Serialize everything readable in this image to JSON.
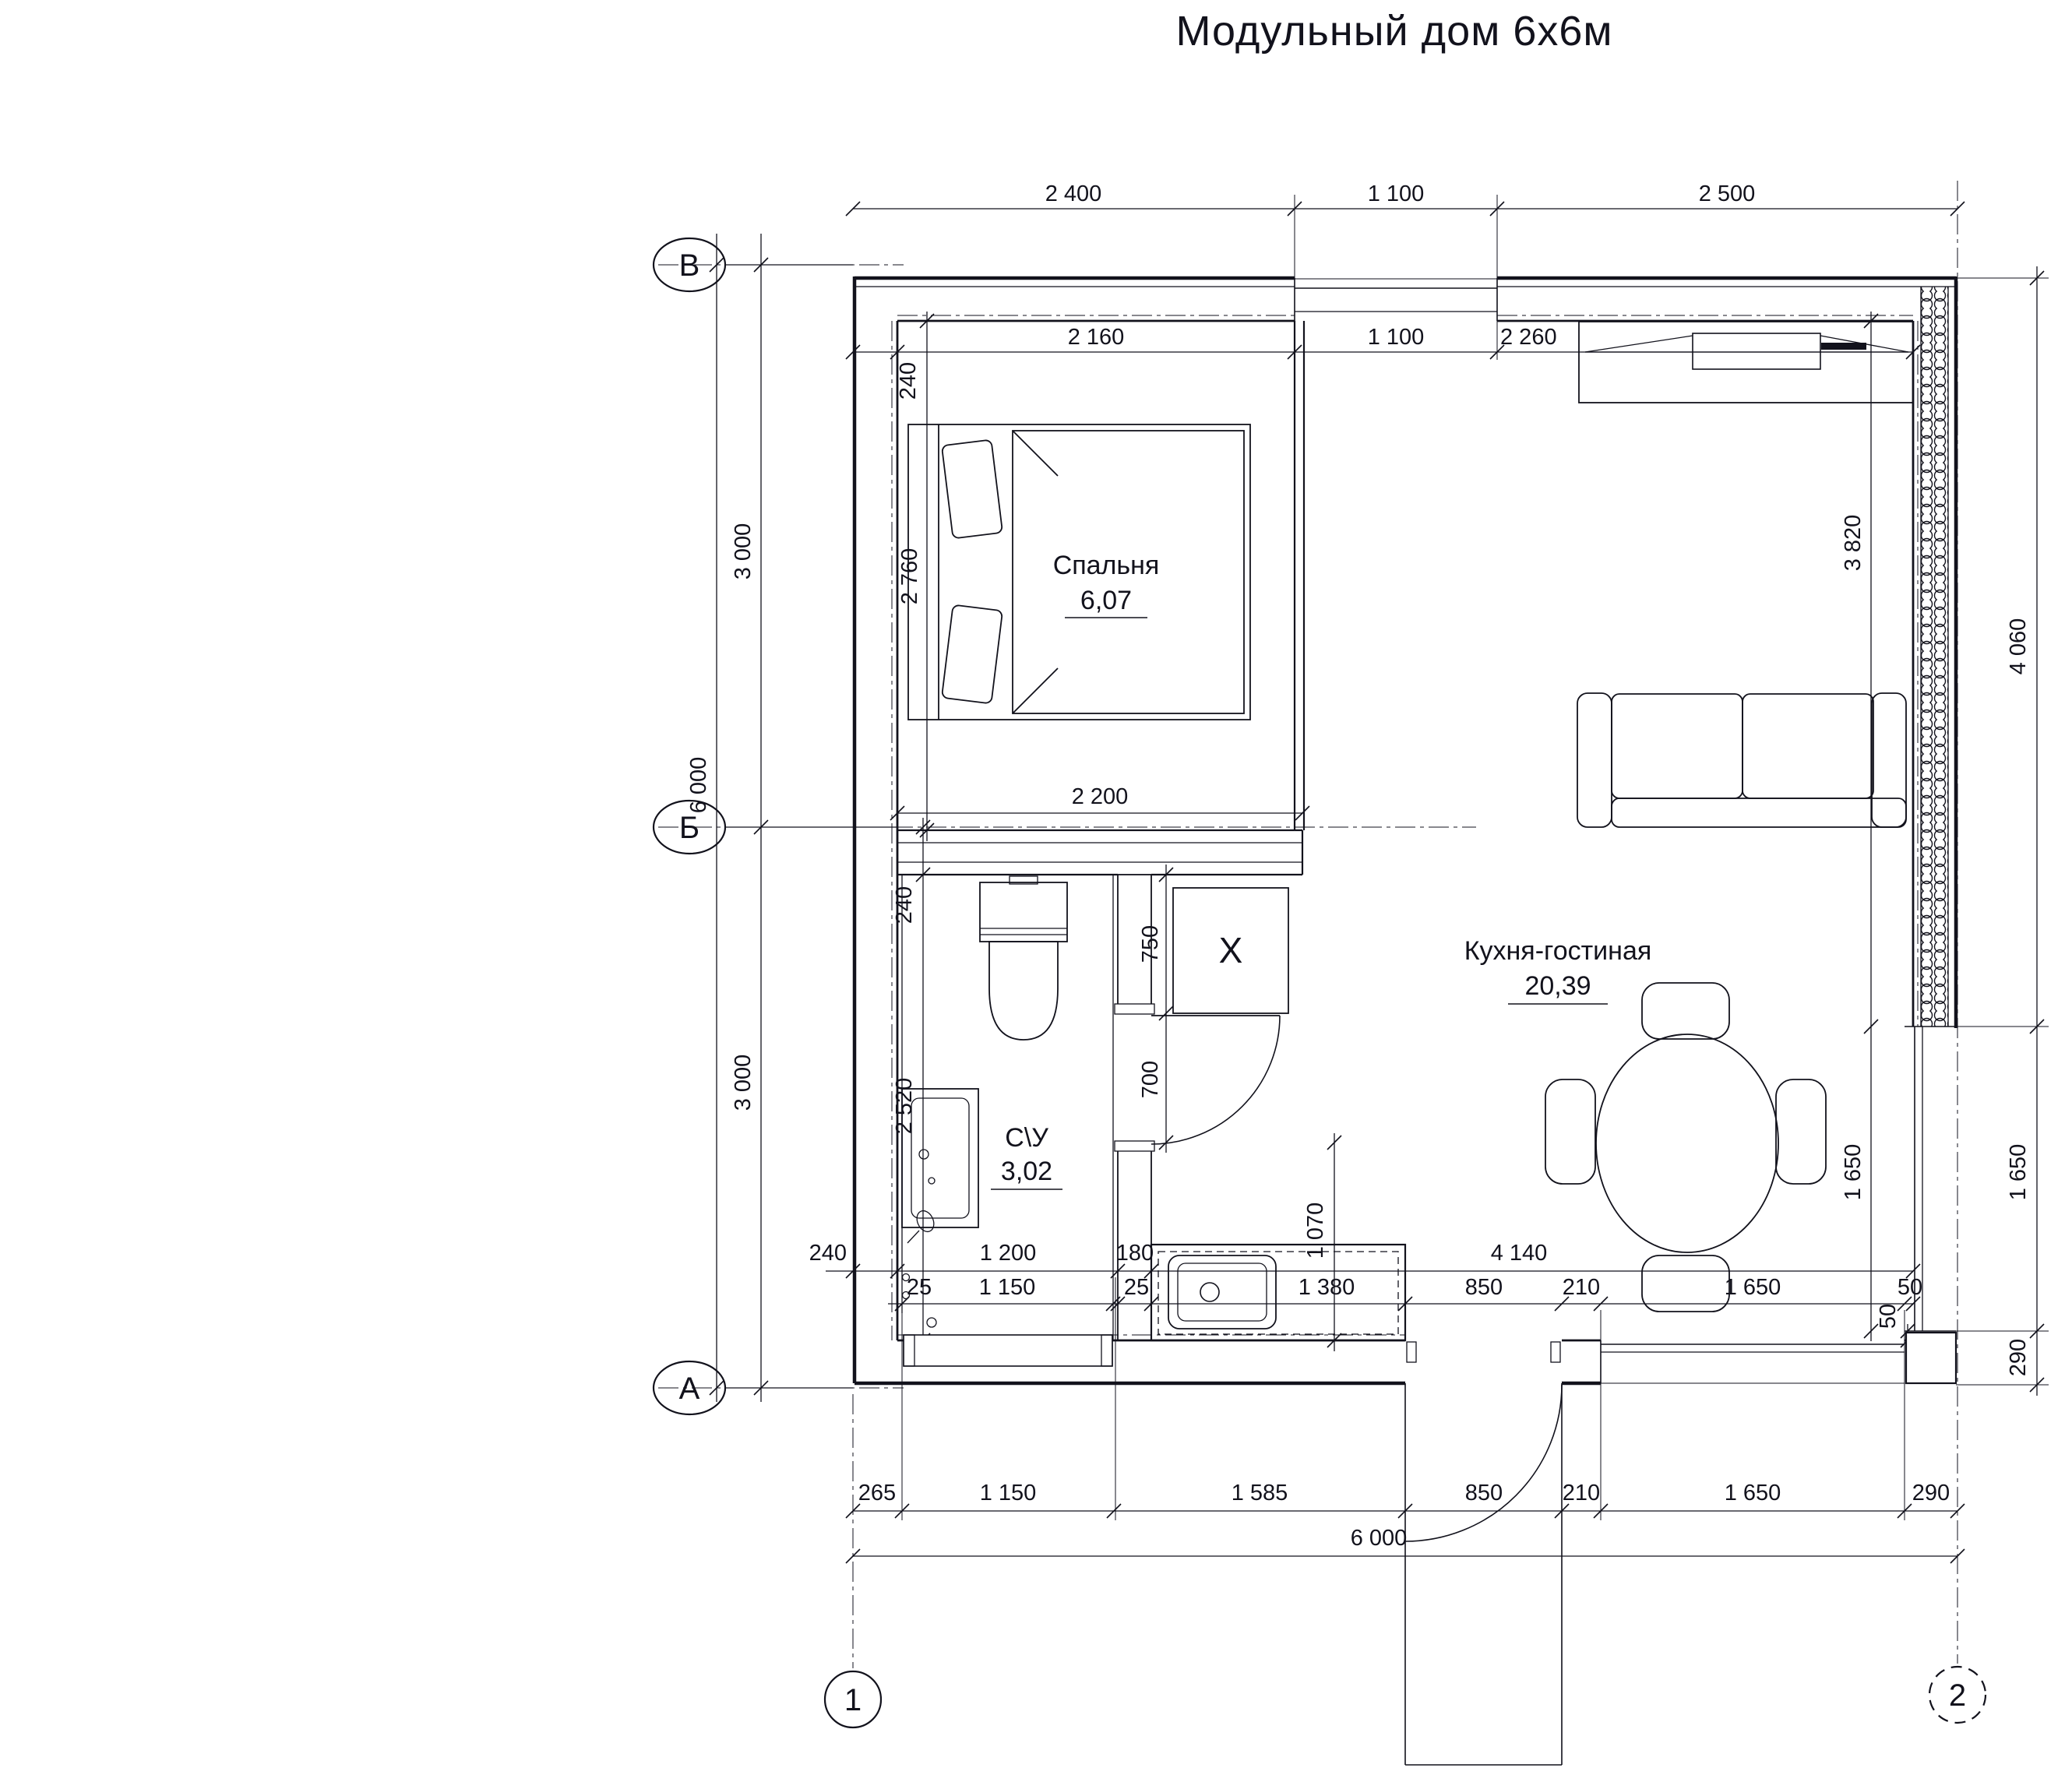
{
  "title": "Модульный дом 6х6м",
  "axes": {
    "rows": [
      "В",
      "Б",
      "А"
    ],
    "cols": [
      "1",
      "2"
    ]
  },
  "rooms": {
    "bedroom": {
      "name": "Спальня",
      "area": "6,07"
    },
    "living": {
      "name": "Кухня-гостиная",
      "area": "20,39"
    },
    "bathroom": {
      "name": "С\\У",
      "area": "3,02"
    }
  },
  "appliances": {
    "washer": "X"
  },
  "dims": {
    "top_outer": [
      "2 400",
      "1 100",
      "2 500"
    ],
    "top_inner": [
      "240",
      "2 160",
      "1 100",
      "2 260"
    ],
    "left": [
      "3 000",
      "6 000",
      "3 000"
    ],
    "bedroom": [
      "2 760",
      "2 200"
    ],
    "bath_left": [
      "240",
      "2 520"
    ],
    "partition": [
      "750",
      "700",
      "1 070"
    ],
    "row_a": [
      "240",
      "1 200",
      "180",
      "4 140"
    ],
    "row_b": [
      "25",
      "1 150",
      "25",
      "1 380",
      "850",
      "210",
      "1 650",
      "50"
    ],
    "corner": [
      "50",
      "290"
    ],
    "right_inner": [
      "3 820",
      "1 650"
    ],
    "right_outer": [
      "4 060",
      "1 650"
    ],
    "bottom": [
      "265",
      "1 150",
      "1 585",
      "850",
      "210",
      "1 650",
      "290"
    ],
    "bottom_total": "6 000"
  }
}
